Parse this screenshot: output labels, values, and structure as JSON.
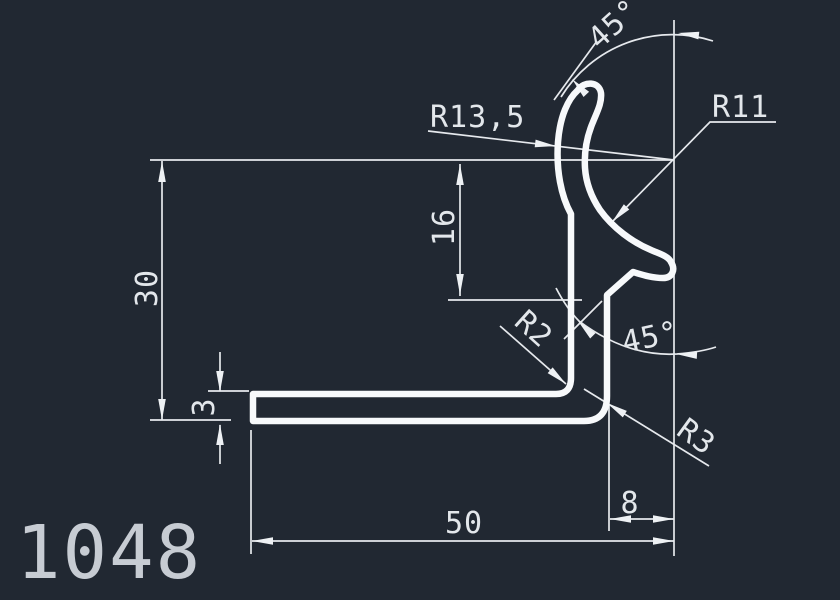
{
  "app": {
    "type": "cad-drawing-viewport"
  },
  "canvas": {
    "background": "#212832",
    "geometry_color": "#f7f9fb",
    "dimension_color": "#e6e9ed",
    "part_number_color": "#c7ccd3"
  },
  "part": {
    "number": "1048"
  },
  "dimensions": {
    "angle_top": "45°",
    "angle_mid": "45°",
    "radius_hook_outer": "R13,5",
    "radius_hook_inner": "R11",
    "radius_inner_corner": "R2",
    "radius_outer_corner": "R3",
    "height_total": "30",
    "height_upper": "16",
    "thickness": "3",
    "width_base": "50",
    "width_step": "8"
  }
}
